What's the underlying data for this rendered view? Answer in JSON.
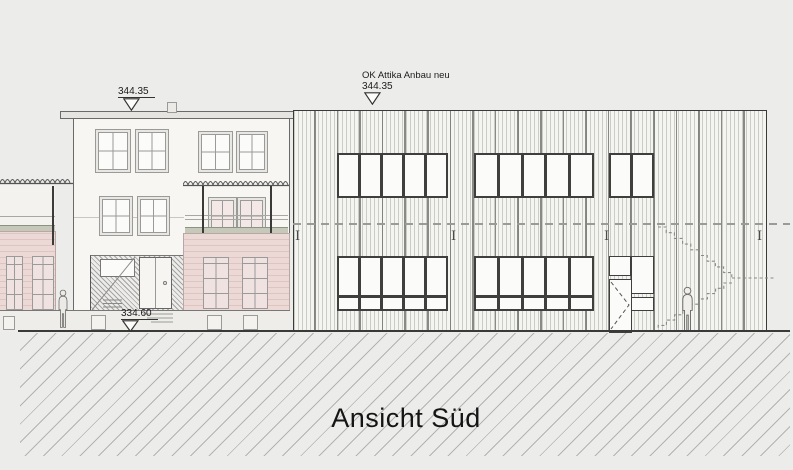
{
  "title": "Ansicht Süd",
  "markers": {
    "existing_roof": {
      "value": "344.35"
    },
    "extension_roof": {
      "label": "OK Attika Anbau neu",
      "value": "344.35"
    },
    "entrance_level": {
      "value": "334.60"
    }
  },
  "symbols": {
    "steel_column_glyph": "I"
  },
  "colors": {
    "background": "#ececea",
    "facade_pink": "#ecd9d6",
    "facade_white": "#f7f6f3",
    "extension_facade": "#f4f4f1",
    "line_dark": "#3a3a38",
    "line_light": "#9a9a98",
    "ground_hatch": "#b3b3b0",
    "greenery": "#c6c8b9"
  }
}
